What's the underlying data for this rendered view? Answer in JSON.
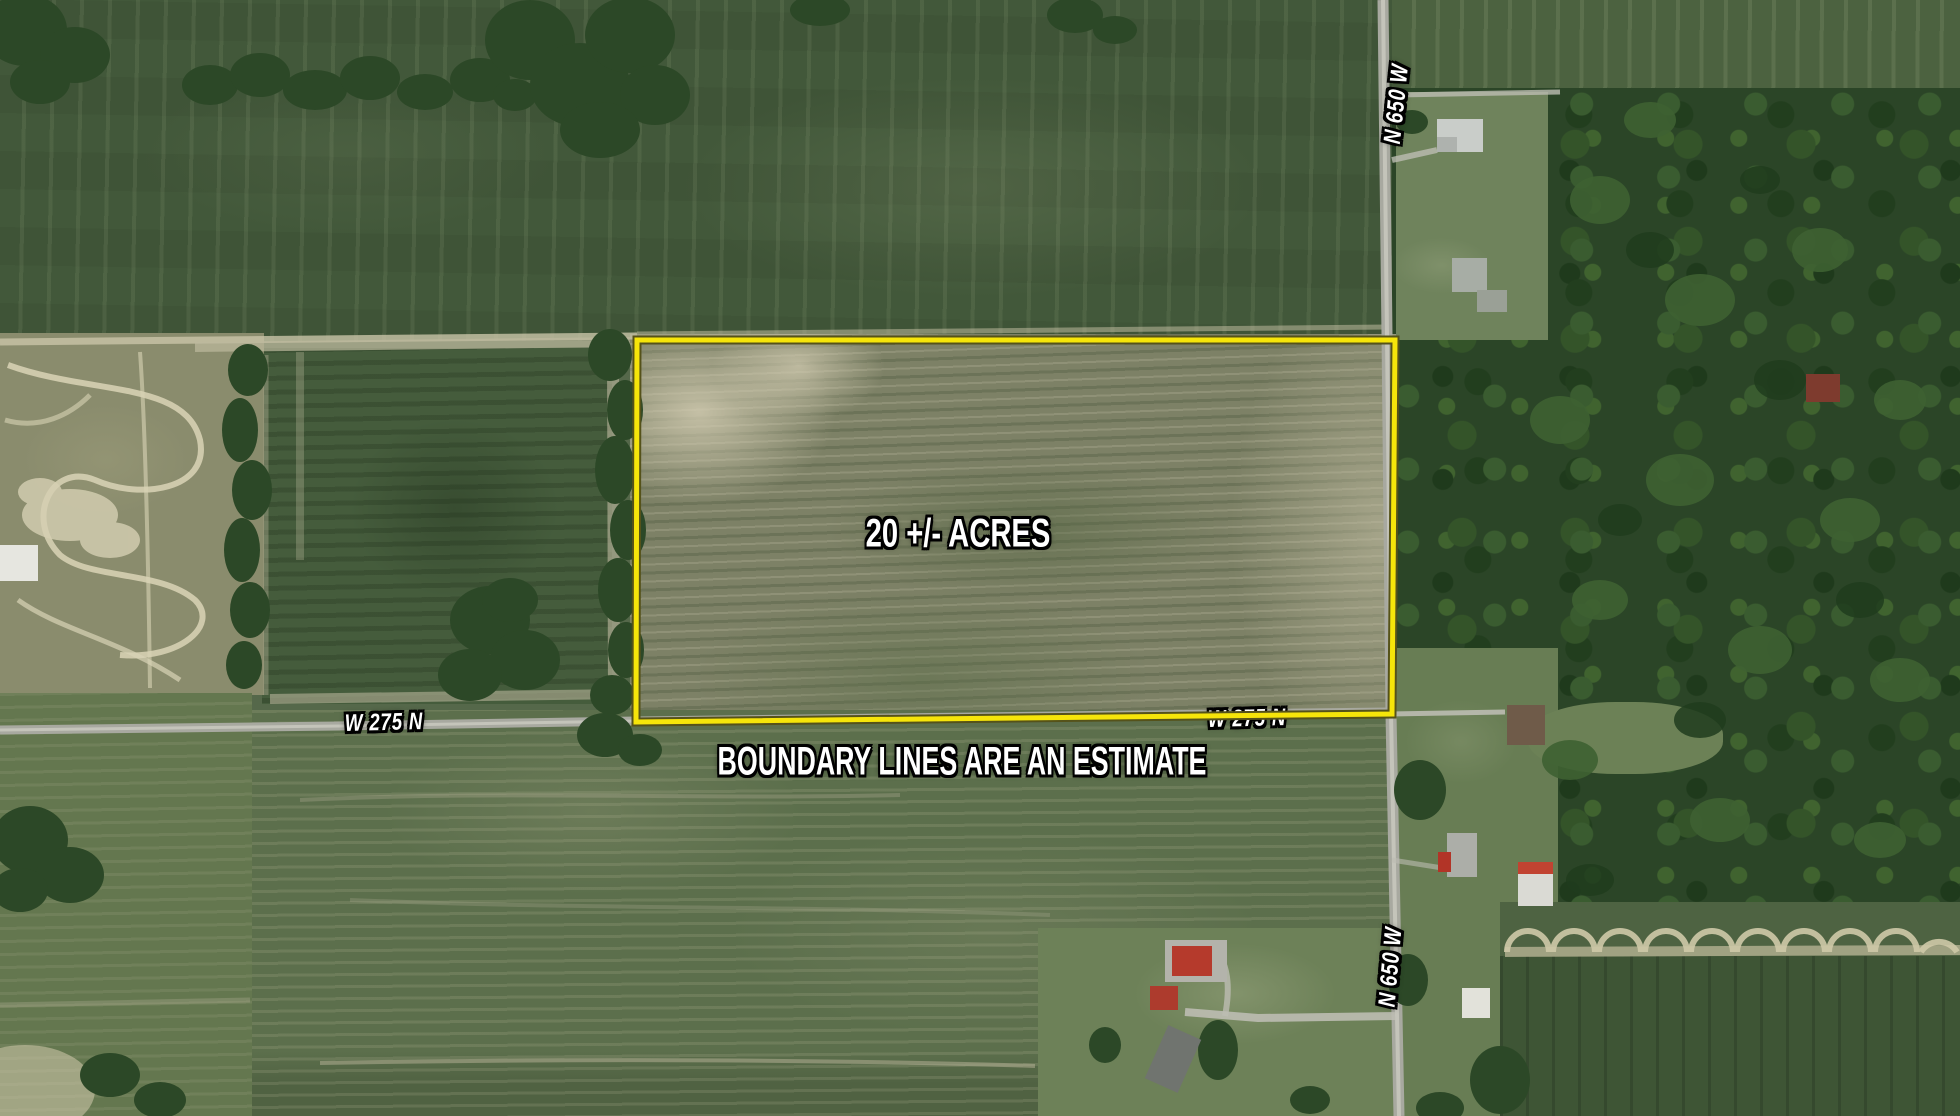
{
  "labels": {
    "acreage": "20 +/- ACRES",
    "disclaimer": "BOUNDARY LINES ARE AN ESTIMATE",
    "road_w275n_west": "W 275 N",
    "road_w275n_east": "W 275 N",
    "road_n650w_north": "N 650 W",
    "road_n650w_south": "N 650 W"
  },
  "colors": {
    "boundary": "#f6e50a",
    "boundary_edge": "#55521a",
    "label_text": "#ffffff",
    "label_outline": "#000000",
    "road": "#a8a9a0"
  }
}
